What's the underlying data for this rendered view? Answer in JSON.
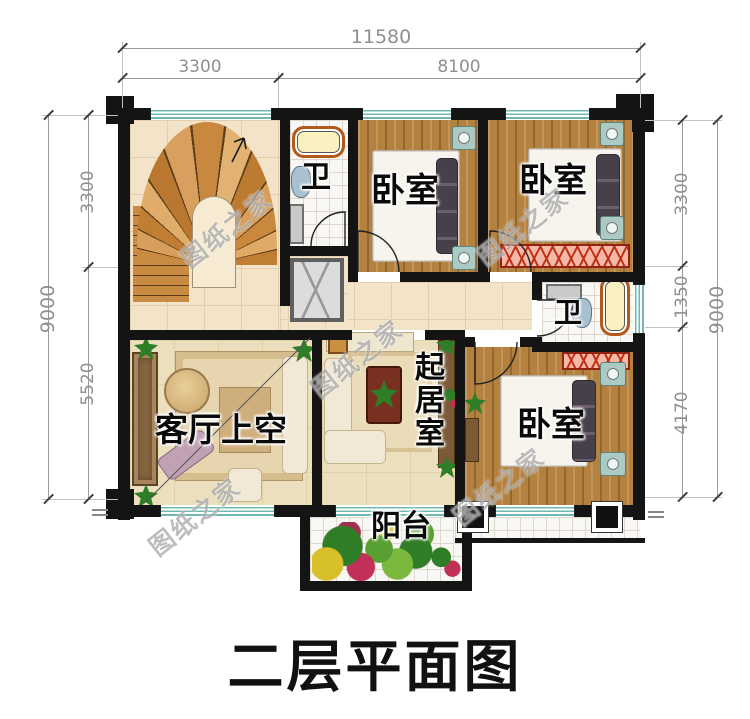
{
  "title": "二层平面图",
  "watermark": "图纸之家",
  "dimensions": {
    "top": {
      "total": "11580",
      "segments": [
        "3300",
        "8100"
      ]
    },
    "left": {
      "total": "9000",
      "segments": [
        "3300",
        "5520"
      ]
    },
    "right": {
      "total": "9000",
      "segments": [
        "3300",
        "1350",
        "4170"
      ]
    }
  },
  "rooms": {
    "bath_top": "卫",
    "bedroom_top_center": "卧室",
    "bedroom_top_right": "卧室",
    "bath_mid": "卫",
    "living_room_void": "客厅上空",
    "sitting_room": "起居室",
    "bedroom_bottom_right": "卧室",
    "balcony": "阳台"
  },
  "colors": {
    "wall": "#141414",
    "wood_floor": "#b5813f",
    "tile_beige": "#f3e3c9",
    "window_teal": "#6fb8b2",
    "dresser_red": "#c23018",
    "title_color": "#111111"
  }
}
